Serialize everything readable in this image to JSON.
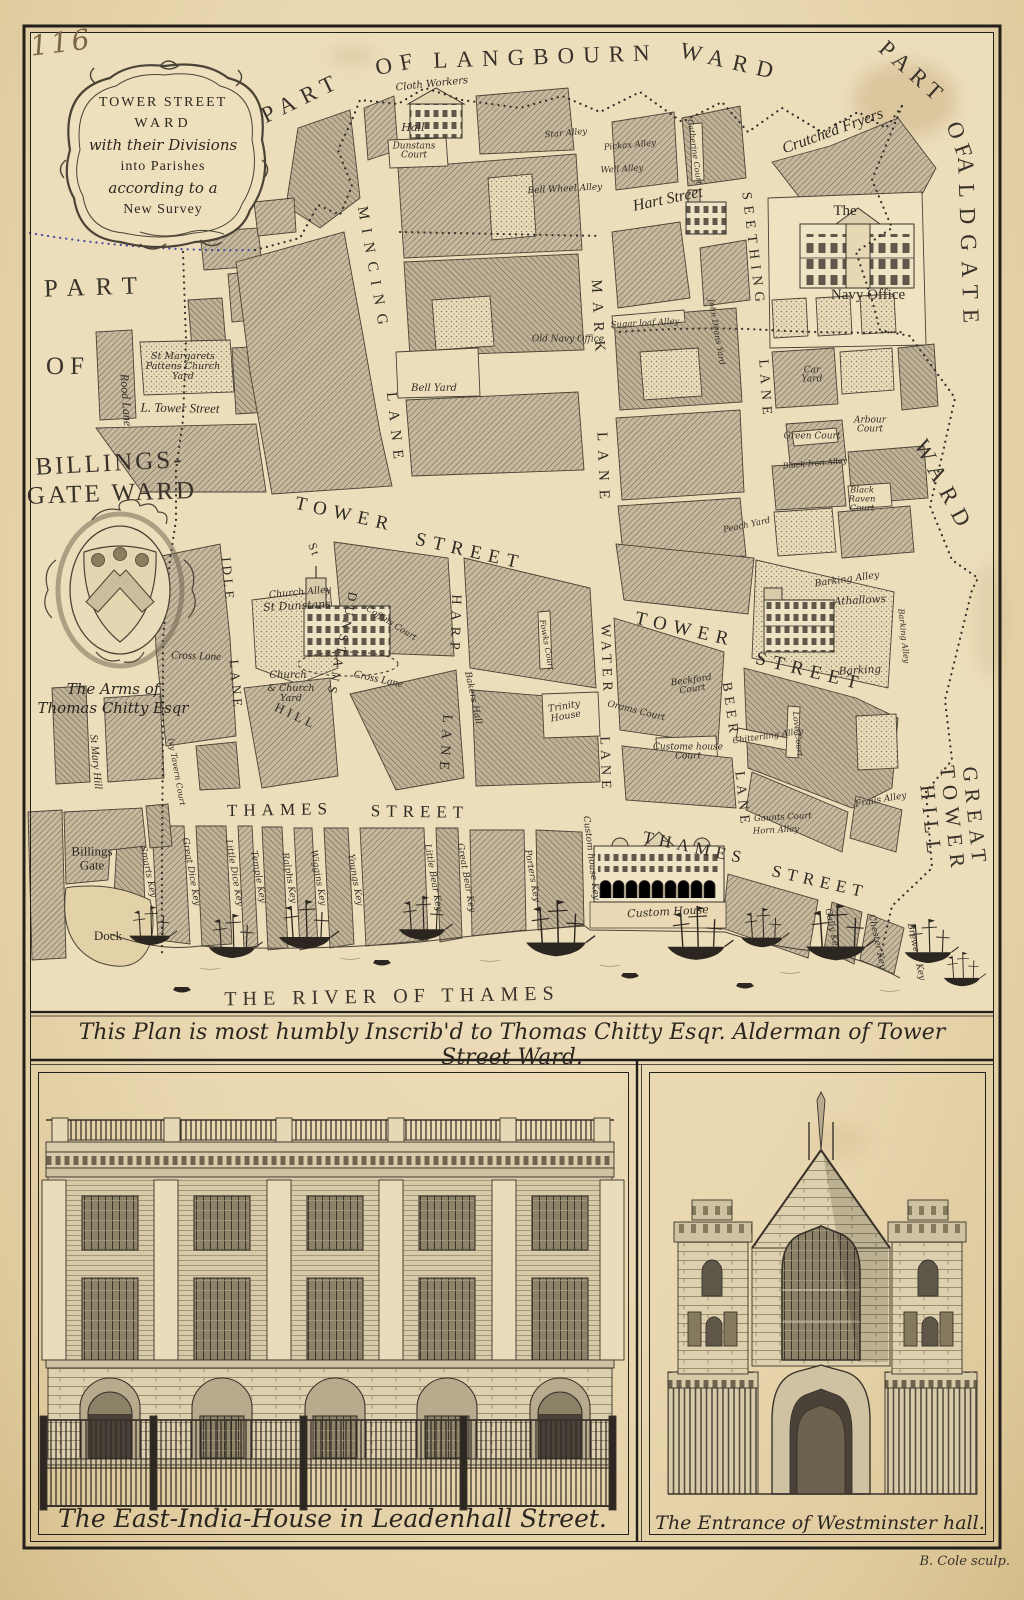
{
  "plate": {
    "page_number": "116",
    "engraver": "B. Cole sculp.",
    "dedication": "This Plan is most humbly Inscrib'd to Thomas Chitty Esqr. Alderman of Tower Street Ward."
  },
  "colors": {
    "paper": "#e9d7b0",
    "ink": "#2b2620",
    "block_hatch": "#c6b99d",
    "boundary_dots": "#3b3455"
  },
  "cartouche": {
    "lines": [
      "TOWER STREET",
      "WARD",
      "with their Divisions",
      "into Parishes",
      "according to a",
      "New Survey"
    ]
  },
  "arms": {
    "caption_line1": "The Arms of",
    "caption_line2": "Thomas Chitty Esqr"
  },
  "captions": {
    "east_india": "The East-India-House in Leadenhall Street.",
    "westminster": "The Entrance of Westminster hall."
  },
  "map_labels": [
    {
      "t": "PART",
      "x": 302,
      "y": 98,
      "r": -26,
      "s": 23,
      "c": "ward",
      "ls": 8
    },
    {
      "t": "OF",
      "x": 398,
      "y": 64,
      "r": -11,
      "s": 23,
      "c": "ward",
      "ls": 8
    },
    {
      "t": "LANGBOURN",
      "x": 546,
      "y": 57,
      "r": -2,
      "s": 23,
      "c": "ward",
      "ls": 9
    },
    {
      "t": "WARD",
      "x": 731,
      "y": 62,
      "r": 13,
      "s": 23,
      "c": "ward",
      "ls": 9
    },
    {
      "t": "PART",
      "x": 913,
      "y": 73,
      "r": 42,
      "s": 23,
      "c": "ward",
      "ls": 7
    },
    {
      "t": "OF",
      "x": 960,
      "y": 143,
      "r": 70,
      "s": 23,
      "c": "ward",
      "ls": 7
    },
    {
      "t": "ALDGATE",
      "x": 968,
      "y": 245,
      "r": 88,
      "s": 23,
      "c": "ward",
      "ls": 10
    },
    {
      "t": "WARD",
      "x": 944,
      "y": 487,
      "r": 62,
      "s": 23,
      "c": "ward",
      "ls": 9
    },
    {
      "t": "GREAT TOWER HILL",
      "x": 953,
      "y": 820,
      "r": 84,
      "s": 21,
      "c": "ward",
      "ls": 7
    },
    {
      "t": "PART",
      "x": 96,
      "y": 288,
      "r": -2,
      "s": 25,
      "c": "ward",
      "ls": 11
    },
    {
      "t": "OF",
      "x": 68,
      "y": 367,
      "r": 0,
      "s": 25,
      "c": "ward",
      "ls": 6
    },
    {
      "t": "BILLINGS-",
      "x": 110,
      "y": 464,
      "r": -3,
      "s": 25,
      "c": "ward",
      "ls": 3
    },
    {
      "t": "GATE WARD",
      "x": 112,
      "y": 494,
      "r": -2,
      "s": 25,
      "c": "ward",
      "ls": 3
    },
    {
      "t": "THE RIVER OF THAMES",
      "x": 392,
      "y": 997,
      "r": -1,
      "s": 20,
      "c": "ward",
      "ls": 6,
      "n": "river-label"
    },
    {
      "t": "MINCING",
      "x": 372,
      "y": 270,
      "r": 80,
      "s": 15,
      "c": "street",
      "ls": 9
    },
    {
      "t": "LANE",
      "x": 394,
      "y": 430,
      "r": 84,
      "s": 15,
      "c": "street",
      "ls": 9
    },
    {
      "t": "MARK",
      "x": 597,
      "y": 320,
      "r": 87,
      "s": 15,
      "c": "street",
      "ls": 9
    },
    {
      "t": "LANE",
      "x": 602,
      "y": 470,
      "r": 88,
      "s": 15,
      "c": "street",
      "ls": 9
    },
    {
      "t": "Hart Street",
      "x": 668,
      "y": 200,
      "r": -12,
      "s": 16,
      "c": "name"
    },
    {
      "t": "SEETHING",
      "x": 752,
      "y": 250,
      "r": 83,
      "s": 14,
      "c": "street",
      "ls": 6
    },
    {
      "t": "LANE",
      "x": 764,
      "y": 390,
      "r": 86,
      "s": 14,
      "c": "street",
      "ls": 6
    },
    {
      "t": "Crutched Fryers",
      "x": 833,
      "y": 132,
      "r": -20,
      "s": 16,
      "c": "name"
    },
    {
      "t": "TOWER",
      "x": 345,
      "y": 515,
      "r": 13,
      "s": 19,
      "c": "street",
      "ls": 7
    },
    {
      "t": "STREET",
      "x": 470,
      "y": 552,
      "r": 13,
      "s": 19,
      "c": "street",
      "ls": 7
    },
    {
      "t": "TOWER",
      "x": 685,
      "y": 630,
      "r": 13,
      "s": 19,
      "c": "street",
      "ls": 7
    },
    {
      "t": "STREET",
      "x": 810,
      "y": 672,
      "r": 14,
      "s": 19,
      "c": "street",
      "ls": 7
    },
    {
      "t": "L. Tower Street",
      "x": 180,
      "y": 408,
      "r": 1,
      "s": 13,
      "c": "name"
    },
    {
      "t": "Rood Lane",
      "x": 126,
      "y": 400,
      "r": 86,
      "s": 12,
      "c": "name"
    },
    {
      "t": "St",
      "x": 314,
      "y": 550,
      "r": 70,
      "s": 12,
      "c": "street",
      "ls": 2
    },
    {
      "t": "DUNSTANS",
      "x": 342,
      "y": 645,
      "r": 102,
      "s": 13,
      "c": "street",
      "ls": 5
    },
    {
      "t": "HILL",
      "x": 296,
      "y": 716,
      "r": 25,
      "s": 13,
      "c": "street",
      "ls": 4
    },
    {
      "t": "HARP",
      "x": 454,
      "y": 625,
      "r": 92,
      "s": 14,
      "c": "street",
      "ls": 6
    },
    {
      "t": "LANE",
      "x": 444,
      "y": 745,
      "r": 94,
      "s": 14,
      "c": "street",
      "ls": 6
    },
    {
      "t": "WATER",
      "x": 605,
      "y": 660,
      "r": 88,
      "s": 14,
      "c": "street",
      "ls": 5
    },
    {
      "t": "LANE",
      "x": 604,
      "y": 765,
      "r": 88,
      "s": 14,
      "c": "street",
      "ls": 5
    },
    {
      "t": "BEER",
      "x": 729,
      "y": 710,
      "r": 82,
      "s": 14,
      "c": "street",
      "ls": 5
    },
    {
      "t": "LANE",
      "x": 741,
      "y": 800,
      "r": 84,
      "s": 14,
      "c": "street",
      "ls": 5
    },
    {
      "t": "IDLE",
      "x": 228,
      "y": 580,
      "r": 85,
      "s": 13,
      "c": "street",
      "ls": 4
    },
    {
      "t": "LANE",
      "x": 236,
      "y": 685,
      "r": 85,
      "s": 13,
      "c": "street",
      "ls": 4
    },
    {
      "t": "THAMES",
      "x": 280,
      "y": 810,
      "r": -1,
      "s": 17,
      "c": "street",
      "ls": 6
    },
    {
      "t": "STREET",
      "x": 420,
      "y": 812,
      "r": 1,
      "s": 17,
      "c": "street",
      "ls": 6
    },
    {
      "t": "THAMES",
      "x": 695,
      "y": 848,
      "r": 12,
      "s": 17,
      "c": "street",
      "ls": 6
    },
    {
      "t": "STREET",
      "x": 820,
      "y": 882,
      "r": 13,
      "s": 17,
      "c": "street",
      "ls": 6
    },
    {
      "t": "St Mary Hill",
      "x": 95,
      "y": 762,
      "r": 85,
      "s": 11,
      "c": "name"
    },
    {
      "t": "Cross Lane",
      "x": 196,
      "y": 657,
      "r": 2,
      "s": 11,
      "c": "name"
    },
    {
      "t": "Cross Lane",
      "x": 378,
      "y": 680,
      "r": 12,
      "s": 11,
      "c": "name"
    },
    {
      "t": "Cloth Workers",
      "x": 432,
      "y": 85,
      "r": -6,
      "s": 10,
      "c": "place"
    },
    {
      "t": "Hall",
      "x": 413,
      "y": 128,
      "r": 0,
      "s": 11,
      "c": "place"
    },
    {
      "t": "Dunstans\nCourt",
      "x": 414,
      "y": 152,
      "r": 0,
      "s": 9,
      "c": "place"
    },
    {
      "t": "Star Alley",
      "x": 566,
      "y": 134,
      "r": -5,
      "s": 8.5,
      "c": "place"
    },
    {
      "t": "Bell Wheel Alley",
      "x": 565,
      "y": 190,
      "r": -3,
      "s": 9,
      "c": "place"
    },
    {
      "t": "Old Navy Office",
      "x": 568,
      "y": 340,
      "r": 0,
      "s": 9,
      "c": "place"
    },
    {
      "t": "Bell Yard",
      "x": 434,
      "y": 389,
      "r": 0,
      "s": 10,
      "c": "place"
    },
    {
      "t": "Pickax Alley",
      "x": 630,
      "y": 146,
      "r": -5,
      "s": 8.5,
      "c": "place"
    },
    {
      "t": "Well Alley",
      "x": 622,
      "y": 170,
      "r": -3,
      "s": 8.5,
      "c": "place"
    },
    {
      "t": "Sugar loaf Alley",
      "x": 645,
      "y": 324,
      "r": -3,
      "s": 8.5,
      "c": "place"
    },
    {
      "t": "Catherine Court",
      "x": 694,
      "y": 152,
      "r": 82,
      "s": 8,
      "c": "place"
    },
    {
      "t": "John Deans Yard",
      "x": 716,
      "y": 332,
      "r": 80,
      "s": 8,
      "c": "place"
    },
    {
      "t": "The",
      "x": 845,
      "y": 212,
      "r": 0,
      "s": 15,
      "c": "proman"
    },
    {
      "t": "Navy Office",
      "x": 868,
      "y": 296,
      "r": 0,
      "s": 15,
      "c": "proman"
    },
    {
      "t": "Car\nYard",
      "x": 812,
      "y": 376,
      "r": 0,
      "s": 9,
      "c": "place"
    },
    {
      "t": "Arbour\nCourt",
      "x": 870,
      "y": 426,
      "r": 0,
      "s": 9,
      "c": "place"
    },
    {
      "t": "Green Court",
      "x": 812,
      "y": 437,
      "r": 0,
      "s": 9,
      "c": "place"
    },
    {
      "t": "Black Iron Alley",
      "x": 815,
      "y": 464,
      "r": -5,
      "s": 8,
      "c": "place"
    },
    {
      "t": "Black\nRaven\nCourt",
      "x": 862,
      "y": 500,
      "r": 0,
      "s": 8.5,
      "c": "place"
    },
    {
      "t": "Peach Yard",
      "x": 747,
      "y": 526,
      "r": -12,
      "s": 8.5,
      "c": "place"
    },
    {
      "t": "Barking Alley",
      "x": 847,
      "y": 580,
      "r": -8,
      "s": 9.5,
      "c": "place"
    },
    {
      "t": "Athallows",
      "x": 860,
      "y": 601,
      "r": -3,
      "s": 10.5,
      "c": "place"
    },
    {
      "t": "Barking",
      "x": 860,
      "y": 671,
      "r": -3,
      "s": 10.5,
      "c": "place"
    },
    {
      "t": "Barking Alley",
      "x": 903,
      "y": 636,
      "r": 84,
      "s": 8,
      "c": "place"
    },
    {
      "t": "Beckford\nCourt",
      "x": 692,
      "y": 686,
      "r": -8,
      "s": 9,
      "c": "place"
    },
    {
      "t": "Orams Court",
      "x": 636,
      "y": 712,
      "r": 14,
      "s": 9,
      "c": "place"
    },
    {
      "t": "Custome house\nCourt",
      "x": 688,
      "y": 753,
      "r": 0,
      "s": 9,
      "c": "place"
    },
    {
      "t": "Chitterling Alley",
      "x": 768,
      "y": 737,
      "r": -8,
      "s": 8.5,
      "c": "place"
    },
    {
      "t": "Love Court",
      "x": 797,
      "y": 734,
      "r": 84,
      "s": 8,
      "c": "place"
    },
    {
      "t": "Frails Alley",
      "x": 881,
      "y": 801,
      "r": -10,
      "s": 9,
      "c": "place"
    },
    {
      "t": "Gaunts Court",
      "x": 783,
      "y": 818,
      "r": -3,
      "s": 8.5,
      "c": "place"
    },
    {
      "t": "Horn Alley",
      "x": 776,
      "y": 831,
      "r": -3,
      "s": 8.5,
      "c": "place"
    },
    {
      "t": "St Margarets\nPattens Church\nYard",
      "x": 183,
      "y": 367,
      "r": 0,
      "s": 9.5,
      "c": "place"
    },
    {
      "t": "Church Alley",
      "x": 300,
      "y": 593,
      "r": -5,
      "s": 9.5,
      "c": "place"
    },
    {
      "t": "St Dunstans",
      "x": 297,
      "y": 606,
      "r": -3,
      "s": 11,
      "c": "place"
    },
    {
      "t": "Church",
      "x": 288,
      "y": 676,
      "r": 0,
      "s": 10,
      "c": "place"
    },
    {
      "t": "& Church\nYard",
      "x": 291,
      "y": 694,
      "r": 0,
      "s": 9.5,
      "c": "place"
    },
    {
      "t": "Coffins Court",
      "x": 391,
      "y": 624,
      "r": 32,
      "s": 8.5,
      "c": "place"
    },
    {
      "t": "Bakers Hall",
      "x": 472,
      "y": 698,
      "r": 78,
      "s": 9,
      "c": "place"
    },
    {
      "t": "Fowks Court",
      "x": 546,
      "y": 645,
      "r": 80,
      "s": 8,
      "c": "place"
    },
    {
      "t": "Trinity\nHouse",
      "x": 565,
      "y": 712,
      "r": -10,
      "s": 9.5,
      "c": "place"
    },
    {
      "t": "Ivy Tavern Court",
      "x": 176,
      "y": 772,
      "r": 80,
      "s": 8,
      "c": "place"
    },
    {
      "t": "Custom House",
      "x": 668,
      "y": 912,
      "r": -3,
      "s": 11,
      "c": "place"
    },
    {
      "t": "Billings\nGate",
      "x": 92,
      "y": 858,
      "r": 0,
      "s": 13,
      "c": "proman"
    },
    {
      "t": "Dock",
      "x": 108,
      "y": 936,
      "r": 0,
      "s": 13,
      "c": "proman"
    },
    {
      "t": "Smarts Key",
      "x": 147,
      "y": 872,
      "r": 78,
      "s": 9,
      "c": "place"
    },
    {
      "t": "Great Dice Key",
      "x": 190,
      "y": 872,
      "r": 80,
      "s": 9,
      "c": "place"
    },
    {
      "t": "Little Dice Key",
      "x": 233,
      "y": 873,
      "r": 80,
      "s": 9,
      "c": "place"
    },
    {
      "t": "Temple Key",
      "x": 257,
      "y": 877,
      "r": 80,
      "s": 9,
      "c": "place"
    },
    {
      "t": "Ralphs Key",
      "x": 288,
      "y": 878,
      "r": 80,
      "s": 9,
      "c": "place"
    },
    {
      "t": "Wiggins Key",
      "x": 317,
      "y": 878,
      "r": 80,
      "s": 9,
      "c": "place"
    },
    {
      "t": "Youngs Key",
      "x": 354,
      "y": 880,
      "r": 80,
      "s": 9,
      "c": "place"
    },
    {
      "t": "Little Bear Key",
      "x": 432,
      "y": 878,
      "r": 80,
      "s": 9,
      "c": "place"
    },
    {
      "t": "Great Bear Key",
      "x": 465,
      "y": 878,
      "r": 80,
      "s": 9,
      "c": "place"
    },
    {
      "t": "Porters Key",
      "x": 531,
      "y": 876,
      "r": 80,
      "s": 9,
      "c": "place"
    },
    {
      "t": "Custom house Key",
      "x": 590,
      "y": 858,
      "r": 83,
      "s": 9,
      "c": "place"
    },
    {
      "t": "Gally Key",
      "x": 831,
      "y": 930,
      "r": 78,
      "s": 9,
      "c": "place"
    },
    {
      "t": "Chester Key",
      "x": 876,
      "y": 942,
      "r": 78,
      "s": 9,
      "c": "place"
    },
    {
      "t": "Brewers Key",
      "x": 915,
      "y": 952,
      "r": 78,
      "s": 9,
      "c": "place"
    }
  ]
}
